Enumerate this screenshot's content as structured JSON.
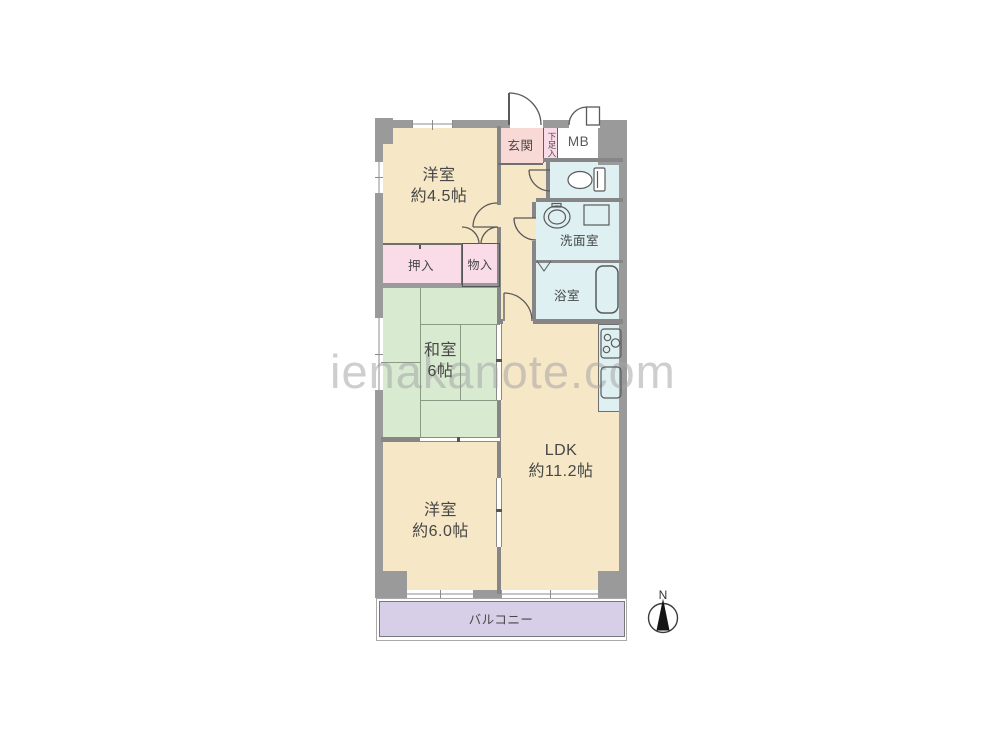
{
  "watermark": {
    "text": "ienakanote.com"
  },
  "compass": {
    "label": "N"
  },
  "rooms": {
    "western_45": {
      "name": "洋室",
      "size": "約4.5帖"
    },
    "entrance": {
      "label": "玄関"
    },
    "shoe_box": {
      "label": "下足入"
    },
    "meter_box": {
      "label": "MB"
    },
    "washroom": {
      "label": "洗面室"
    },
    "bathroom": {
      "label": "浴室"
    },
    "closet_oshiire": {
      "label": "押入"
    },
    "closet_monoire": {
      "label": "物入"
    },
    "japanese_room": {
      "name": "和室",
      "size": "6帖"
    },
    "ldk": {
      "name": "LDK",
      "size": "約11.2帖"
    },
    "western_60": {
      "name": "洋室",
      "size": "約6.0帖"
    },
    "balcony": {
      "label": "バルコニー"
    }
  },
  "colors": {
    "cream": "#f6e7c6",
    "pink": "#fadce8",
    "salmon": "#f8d9d5",
    "green": "#d8ead0",
    "cyan": "#def0f2",
    "lavender": "#d7cfe7",
    "wall": "#9a9a9a",
    "iwall": "#868686"
  }
}
